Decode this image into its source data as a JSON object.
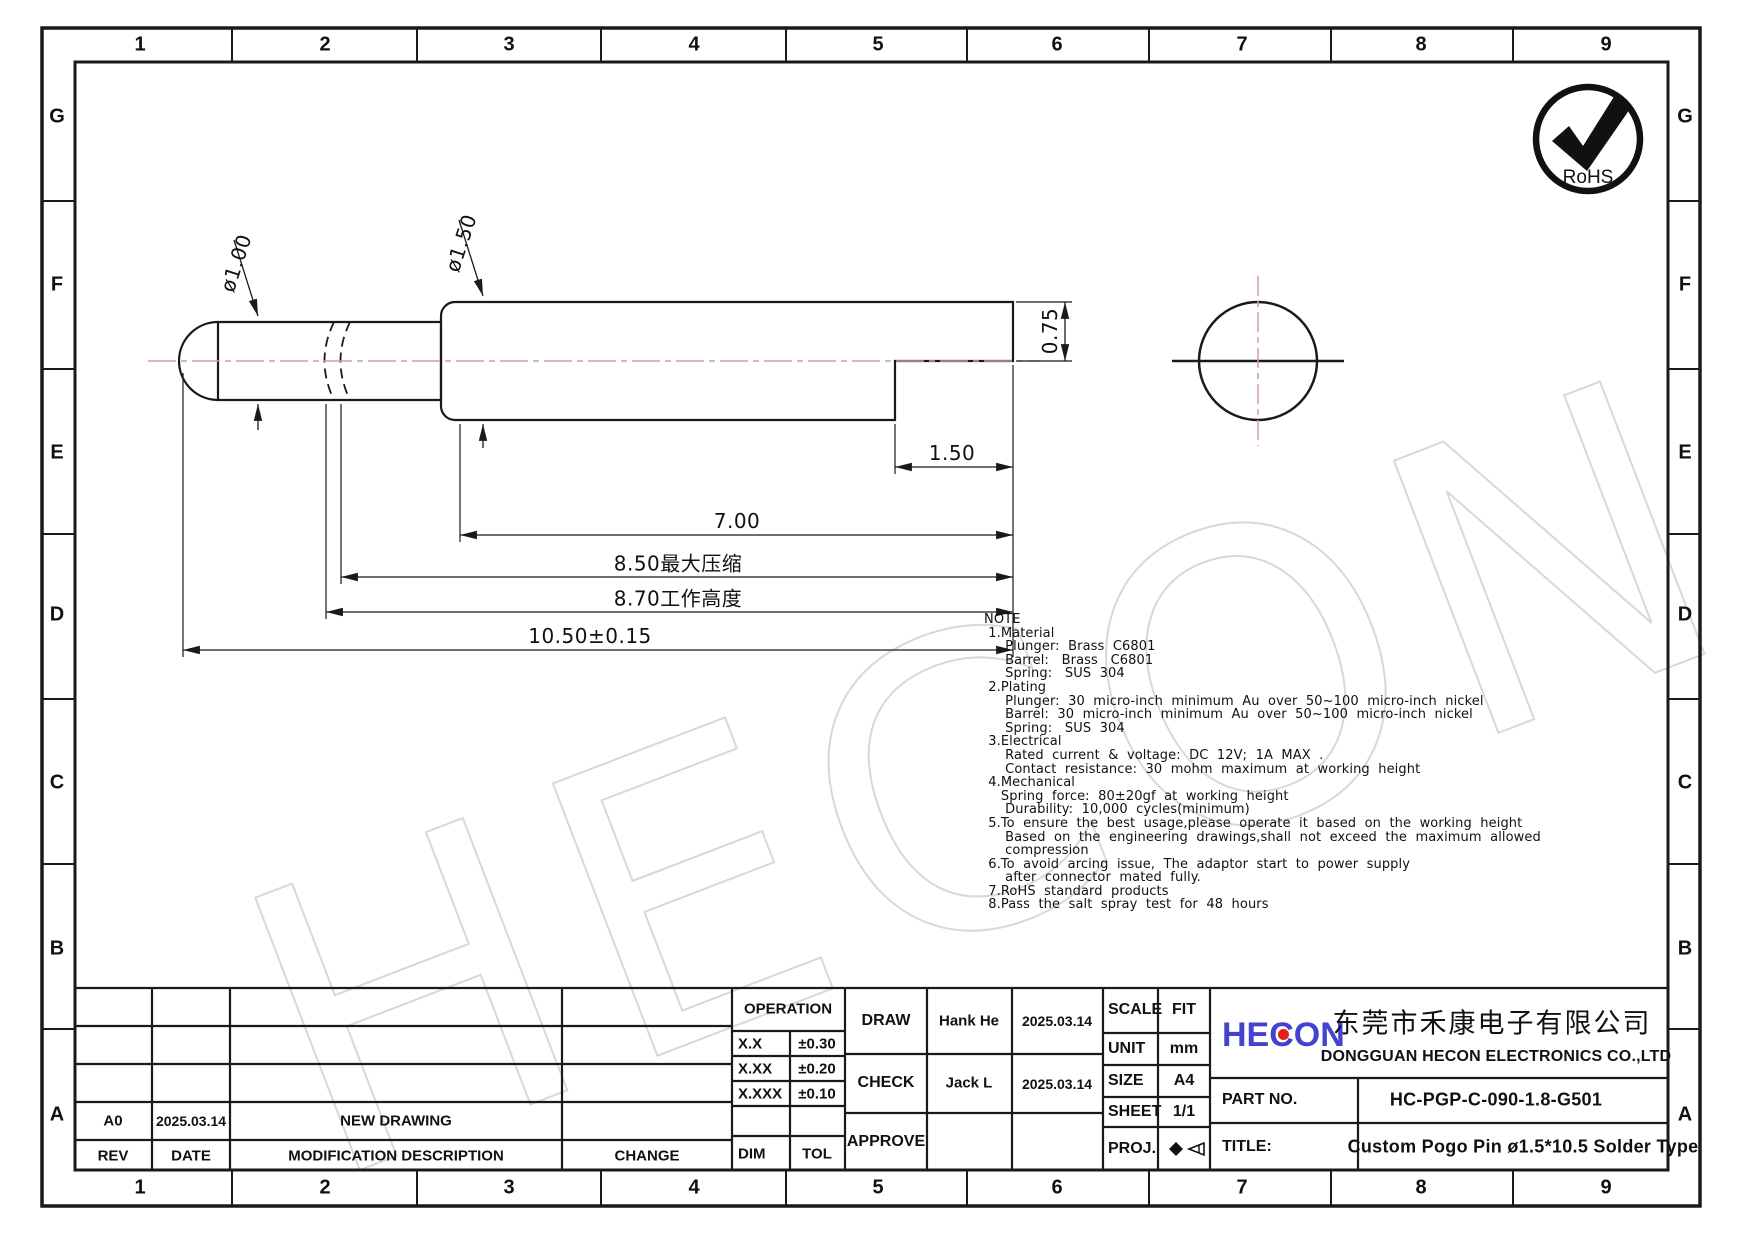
{
  "grid": {
    "cols": [
      "1",
      "2",
      "3",
      "4",
      "5",
      "6",
      "7",
      "8",
      "9"
    ],
    "rows": [
      "G",
      "F",
      "E",
      "D",
      "C",
      "B",
      "A"
    ]
  },
  "watermark": {
    "text": "HECON"
  },
  "rohs": {
    "label": "RoHS"
  },
  "drawing": {
    "dims": {
      "plunger_dia": "ø1.00",
      "barrel_dia": "ø1.50",
      "tail_height": "0.75",
      "tail_length": "1.50",
      "barrel_length": "7.00",
      "max_compression": "8.50最大压缩",
      "working_height": "8.70工作高度",
      "total_length": "10.50±0.15"
    }
  },
  "note": {
    "lines": [
      "NOTE",
      " 1.Material",
      "     Plunger:  Brass  C6801",
      "     Barrel:   Brass   C6801",
      "     Spring:   SUS  304",
      " 2.Plating",
      "     Plunger:  30  micro-inch  minimum  Au  over  50~100  micro-inch  nickel",
      "     Barrel:  30  micro-inch  minimum  Au  over  50~100  micro-inch  nickel",
      "     Spring:   SUS  304",
      " 3.Electrical",
      "     Rated  current  &  voltage:  DC  12V;  1A  MAX  .",
      "     Contact  resistance:  30  mohm  maximum  at  working  height",
      " 4.Mechanical",
      "    Spring  force:  80±20gf  at  working  height",
      "     Durability:  10,000  cycles(minimum)",
      " 5.To  ensure  the  best  usage,please  operate  it  based  on  the  working  height",
      "     Based  on  the  engineering  drawings,shall  not  exceed  the  maximum  allowed",
      "     compression",
      " 6.To  avoid  arcing  issue,  The  adaptor  start  to  power  supply",
      "     after  connector  mated  fully.",
      " 7.RoHS  standard  products",
      " 8.Pass  the  salt  spray  test  for  48  hours"
    ]
  },
  "title_block": {
    "revision": {
      "headers": [
        "REV",
        "DATE",
        "MODIFICATION  DESCRIPTION",
        "CHANGE"
      ],
      "rows": [
        {
          "rev": "A0",
          "date": "2025.03.14",
          "description": "NEW  DRAWING",
          "change": ""
        }
      ]
    },
    "operation": {
      "header": "OPERATION",
      "rows": [
        [
          "X.X",
          "±0.30"
        ],
        [
          "X.XX",
          "±0.20"
        ],
        [
          "X.XXX",
          "±0.10"
        ]
      ],
      "footer": [
        "DIM",
        "TOL"
      ]
    },
    "signoff": {
      "draw_label": "DRAW",
      "draw_name": "Hank He",
      "draw_date": "2025.03.14",
      "check_label": "CHECK",
      "check_name": "Jack L",
      "check_date": "2025.03.14",
      "approve_label": "APPROVE"
    },
    "info": {
      "scale_label": "SCALE",
      "scale": "FIT",
      "unit_label": "UNIT",
      "unit": "mm",
      "size_label": "SIZE",
      "size": "A4",
      "sheet_label": "SHEET",
      "sheet": "1/1",
      "proj_label": "PROJ."
    },
    "company": {
      "logo": "HECON",
      "name_cn": "东莞市禾康电子有限公司",
      "name_en": "DONGGUAN HECON ELECTRONICS CO.,LTD"
    },
    "part": {
      "label": "PART NO.",
      "value": "HC-PGP-C-090-1.8-G501"
    },
    "title": {
      "label": "TITLE:",
      "value": "Custom Pogo Pin ø1.5*10.5 Solder Type"
    }
  },
  "colors": {
    "logo_blue": "#4343d0",
    "logo_red": "#e32119",
    "centerline_pink": "#d89a9a",
    "watermark_gray": "#d8d8d8",
    "line_black": "#1a1a1a"
  }
}
